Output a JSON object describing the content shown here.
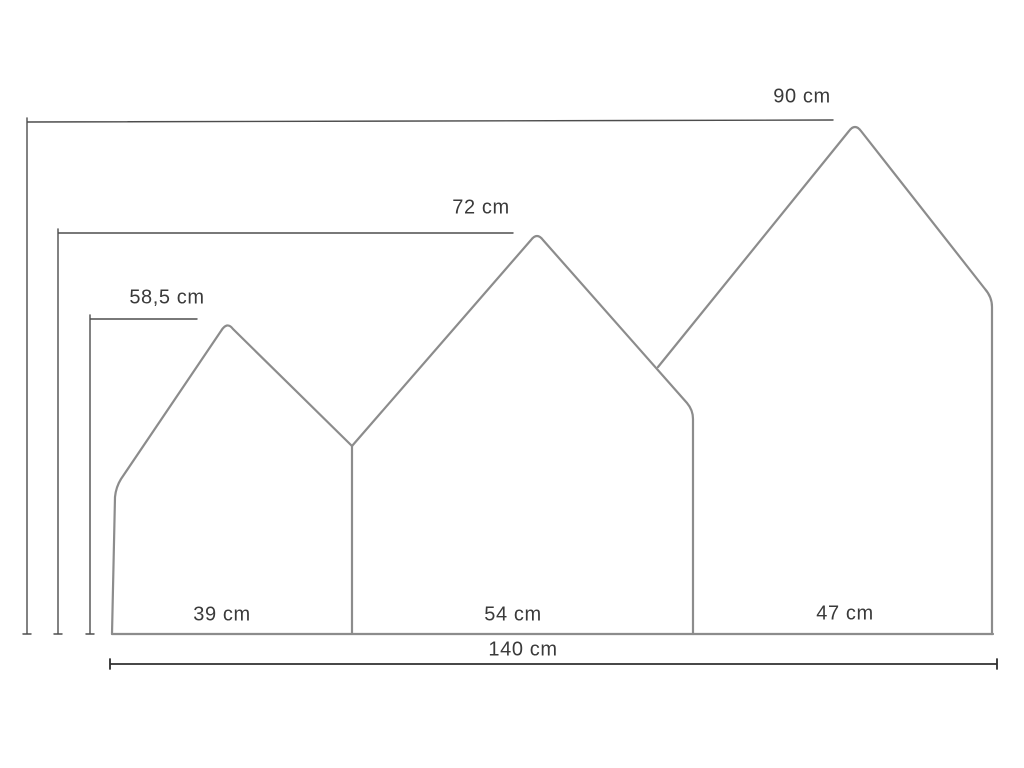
{
  "diagram": {
    "name": "house-headboard-dimension-drawing",
    "unit": "cm",
    "heights": {
      "right_house": {
        "label": "90 cm",
        "value": 90
      },
      "middle_house": {
        "label": "72 cm",
        "value": 72
      },
      "left_house": {
        "label": "58,5 cm",
        "value": 58.5
      }
    },
    "widths": {
      "left_house": {
        "label": "39 cm",
        "value": 39
      },
      "middle_house": {
        "label": "54 cm",
        "value": 54
      },
      "right_house": {
        "label": "47 cm",
        "value": 47
      }
    },
    "total_width": {
      "label": "140 cm",
      "value": 140
    },
    "colors": {
      "background": "#ffffff",
      "house_outline": "#8c8c8c",
      "dimension_line": "#4d4d4d",
      "total_dimension_line": "#2e2e2e",
      "label_text": "#3a3a3a"
    }
  }
}
